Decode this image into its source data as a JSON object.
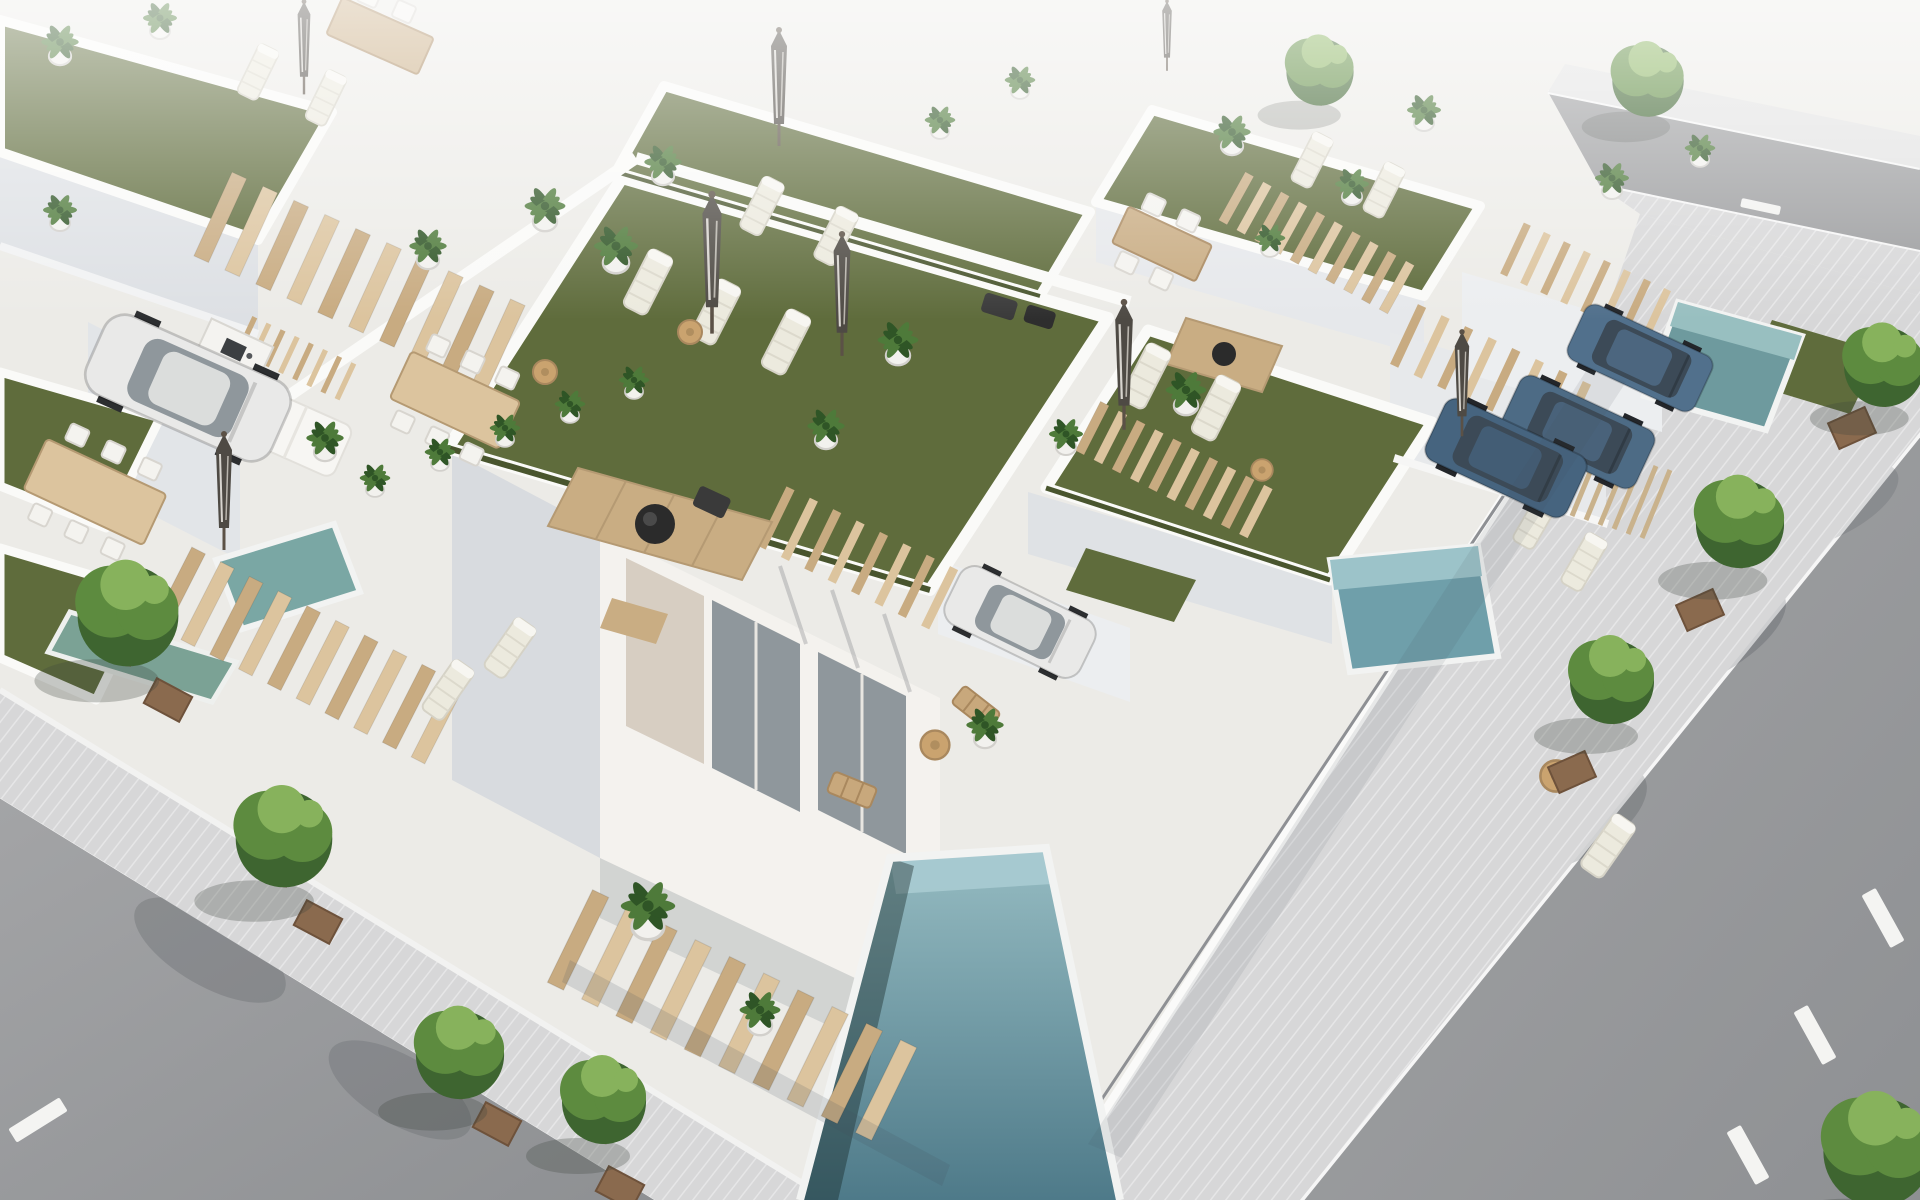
{
  "image": {
    "description": "Aerial 3D architectural rendering of a modern white villa development with rooftop artificial-turf terraces, sun loungers, closed parasols, potted palms, private plunge pools, wooden stairs and pergolas, parked cars, and tree-lined streets",
    "view": "high-angle oblique aerial",
    "style": "photorealistic CGI marketing render",
    "width_px": 1920,
    "height_px": 1200
  },
  "palette": {
    "bg": "#ecebe8",
    "roofWhite": "#f3f2f0",
    "wallLit": "#fafaf8",
    "wallShade": "#d8dbdf",
    "wallDark": "#c2c7ce",
    "patio": "#ecebe7",
    "turf": "#5f6c3c",
    "turfDark": "#49552e",
    "poolDeep": "#4e7a89",
    "poolLight": "#96bcc2",
    "poolRim": "#f2f3f2",
    "road": "#9b9c9e",
    "roadShade": "#8b8d90",
    "sidewalk": "#d7d7d8",
    "curb": "#f6f6f6",
    "wood": "#c8ab81",
    "woodLight": "#dcc49e",
    "woodDark": "#a98f68",
    "planter": "#8a6a4e",
    "treeGreen": "#5d8b3f",
    "treeLight": "#87b25c",
    "treeDark": "#3e6530",
    "palmGreen": "#4e7a3a",
    "palmDark": "#2f5526",
    "carWhite": "#e9e9e8",
    "carBlue": "#46647f",
    "carBlue2": "#51708c",
    "glass": "#8f979c",
    "stone": "#d7cec2",
    "lounger": "#eceade",
    "umbrella": "#4e4a44"
  },
  "scene": {
    "roads": [
      {
        "name": "right-road",
        "surface": "gray asphalt",
        "markings": "white dashed centerline, 3 dashes visible"
      },
      {
        "name": "lower-left-road",
        "surface": "gray asphalt",
        "markings": "white curb line, one dash"
      },
      {
        "name": "upper-right-road",
        "surface": "gray asphalt",
        "markings": "short white dash"
      }
    ],
    "sidewalks": [
      {
        "name": "right-sidewalk",
        "trees": 4,
        "tree_planters": "square, brown"
      },
      {
        "name": "left-sidewalk",
        "trees": 4,
        "tree_planters": "square, brown"
      }
    ],
    "pools": [
      {
        "name": "front-villa-pool",
        "shape": "long rectangle",
        "color": "steel teal"
      },
      {
        "name": "right-row-pool-near",
        "color": "teal"
      },
      {
        "name": "right-row-pool-far",
        "color": "teal"
      },
      {
        "name": "left-courtyard-pool",
        "color": "teal"
      },
      {
        "name": "upper-left-pool",
        "color": "green-teal"
      }
    ],
    "cars": [
      {
        "name": "white-sedan-upper-left",
        "color": "white"
      },
      {
        "name": "white-sedan-front-carport",
        "color": "white"
      },
      {
        "name": "dark-blue-suv-right",
        "color": "dark steel blue"
      },
      {
        "name": "blue-car-upper-right-1",
        "color": "steel blue"
      },
      {
        "name": "blue-car-upper-right-2",
        "color": "steel blue"
      }
    ],
    "rooftop_terraces": [
      {
        "name": "front-villa-roof",
        "features": [
          "large turf",
          "3 loungers",
          "2 closed parasols",
          "round side table",
          "wood deck tiles with black fire bowl",
          "dining table with 6 chairs",
          "outdoor kitchen counter",
          "potted palms"
        ]
      },
      {
        "name": "right-mid-roof",
        "features": [
          "turf",
          "2 loungers",
          "dining table",
          "wood deck with fire bowl",
          "closed parasol"
        ]
      },
      {
        "name": "top-center-roof",
        "features": [
          "turf",
          "2 loungers",
          "closed parasol",
          "black fire bowl set"
        ]
      },
      {
        "name": "top-right-roof",
        "features": [
          "turf",
          "2 loungers",
          "dining table",
          "potted palms"
        ]
      },
      {
        "name": "top-left-roof",
        "features": [
          "turf",
          "2 loungers",
          "wood table",
          "closed parasol",
          "white day bed"
        ]
      }
    ],
    "wood_elements": [
      "5 slatted staircases",
      "4 pergolas",
      "slatted privacy fence",
      "deck chairs",
      "dining tables"
    ],
    "vegetation": {
      "street_trees": 10,
      "potted_palms": 20,
      "tropical_plant_row": 5,
      "turf_patches": 9
    }
  }
}
